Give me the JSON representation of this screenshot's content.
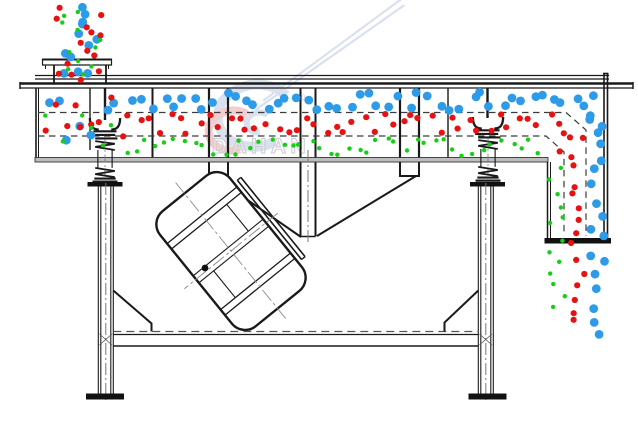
{
  "watermark": {
    "brand": "DAHAN",
    "registered": "®"
  },
  "colors": {
    "blue": "#2D9BE8",
    "red": "#E81111",
    "green": "#17CE17",
    "line": "#1a1a1a",
    "dash_gray": "#3c3c3c",
    "centerline_gray": "#777777",
    "watermark_blue": "#b6c3de",
    "watermark_red": "#e89a9a",
    "watermark_text": "#969da8"
  },
  "particles": {
    "radius": {
      "blue": 4.4,
      "red": 3.1,
      "green": 2.2
    },
    "fields": [
      {
        "name": "feed-stream-blue",
        "color": "blue",
        "x": 58,
        "y": 4,
        "w": 46,
        "h": 58,
        "n": 9,
        "seed": 11
      },
      {
        "name": "feed-stream-red",
        "color": "red",
        "x": 56,
        "y": 6,
        "w": 48,
        "h": 58,
        "n": 10,
        "seed": 12
      },
      {
        "name": "feed-stream-green",
        "color": "green",
        "x": 62,
        "y": 8,
        "w": 44,
        "h": 56,
        "n": 8,
        "seed": 13
      },
      {
        "name": "collar-blue",
        "color": "blue",
        "x": 58,
        "y": 64,
        "w": 40,
        "h": 22,
        "n": 3,
        "seed": 14
      },
      {
        "name": "collar-red",
        "color": "red",
        "x": 56,
        "y": 64,
        "w": 44,
        "h": 24,
        "n": 4,
        "seed": 15
      },
      {
        "name": "collar-green",
        "color": "green",
        "x": 60,
        "y": 66,
        "w": 40,
        "h": 22,
        "n": 3,
        "seed": 16
      },
      {
        "name": "inlet-mix-blue",
        "color": "blue",
        "x": 42,
        "y": 90,
        "w": 80,
        "h": 66,
        "n": 7,
        "seed": 17
      },
      {
        "name": "inlet-mix-red",
        "color": "red",
        "x": 42,
        "y": 92,
        "w": 82,
        "h": 64,
        "n": 9,
        "seed": 18
      },
      {
        "name": "inlet-mix-green",
        "color": "green",
        "x": 44,
        "y": 96,
        "w": 78,
        "h": 60,
        "n": 6,
        "seed": 19
      },
      {
        "name": "coarse-layer-blue",
        "color": "blue",
        "x": 128,
        "y": 92,
        "w": 472,
        "h": 19,
        "n": 46,
        "seed": 21
      },
      {
        "name": "blue-turn-down",
        "color": "blue",
        "x": 586,
        "y": 112,
        "w": 18,
        "h": 24,
        "n": 4,
        "seed": 22
      },
      {
        "name": "middle-layer-red",
        "color": "red",
        "x": 126,
        "y": 114,
        "w": 446,
        "h": 20,
        "n": 46,
        "seed": 23
      },
      {
        "name": "red-turn-down",
        "color": "red",
        "x": 556,
        "y": 136,
        "w": 32,
        "h": 16,
        "n": 3,
        "seed": 24
      },
      {
        "name": "fine-layer-green",
        "color": "green",
        "x": 122,
        "y": 138,
        "w": 424,
        "h": 18,
        "n": 44,
        "seed": 25
      },
      {
        "name": "outlet-column-green",
        "color": "green",
        "x": 549,
        "y": 162,
        "w": 16,
        "h": 150,
        "n": 13,
        "seed": 26
      },
      {
        "name": "outlet-column-red",
        "color": "red",
        "x": 571,
        "y": 152,
        "w": 15,
        "h": 176,
        "n": 14,
        "seed": 27
      },
      {
        "name": "outlet-column-blue",
        "color": "blue",
        "x": 590,
        "y": 138,
        "w": 15,
        "h": 200,
        "n": 15,
        "seed": 28
      }
    ]
  }
}
